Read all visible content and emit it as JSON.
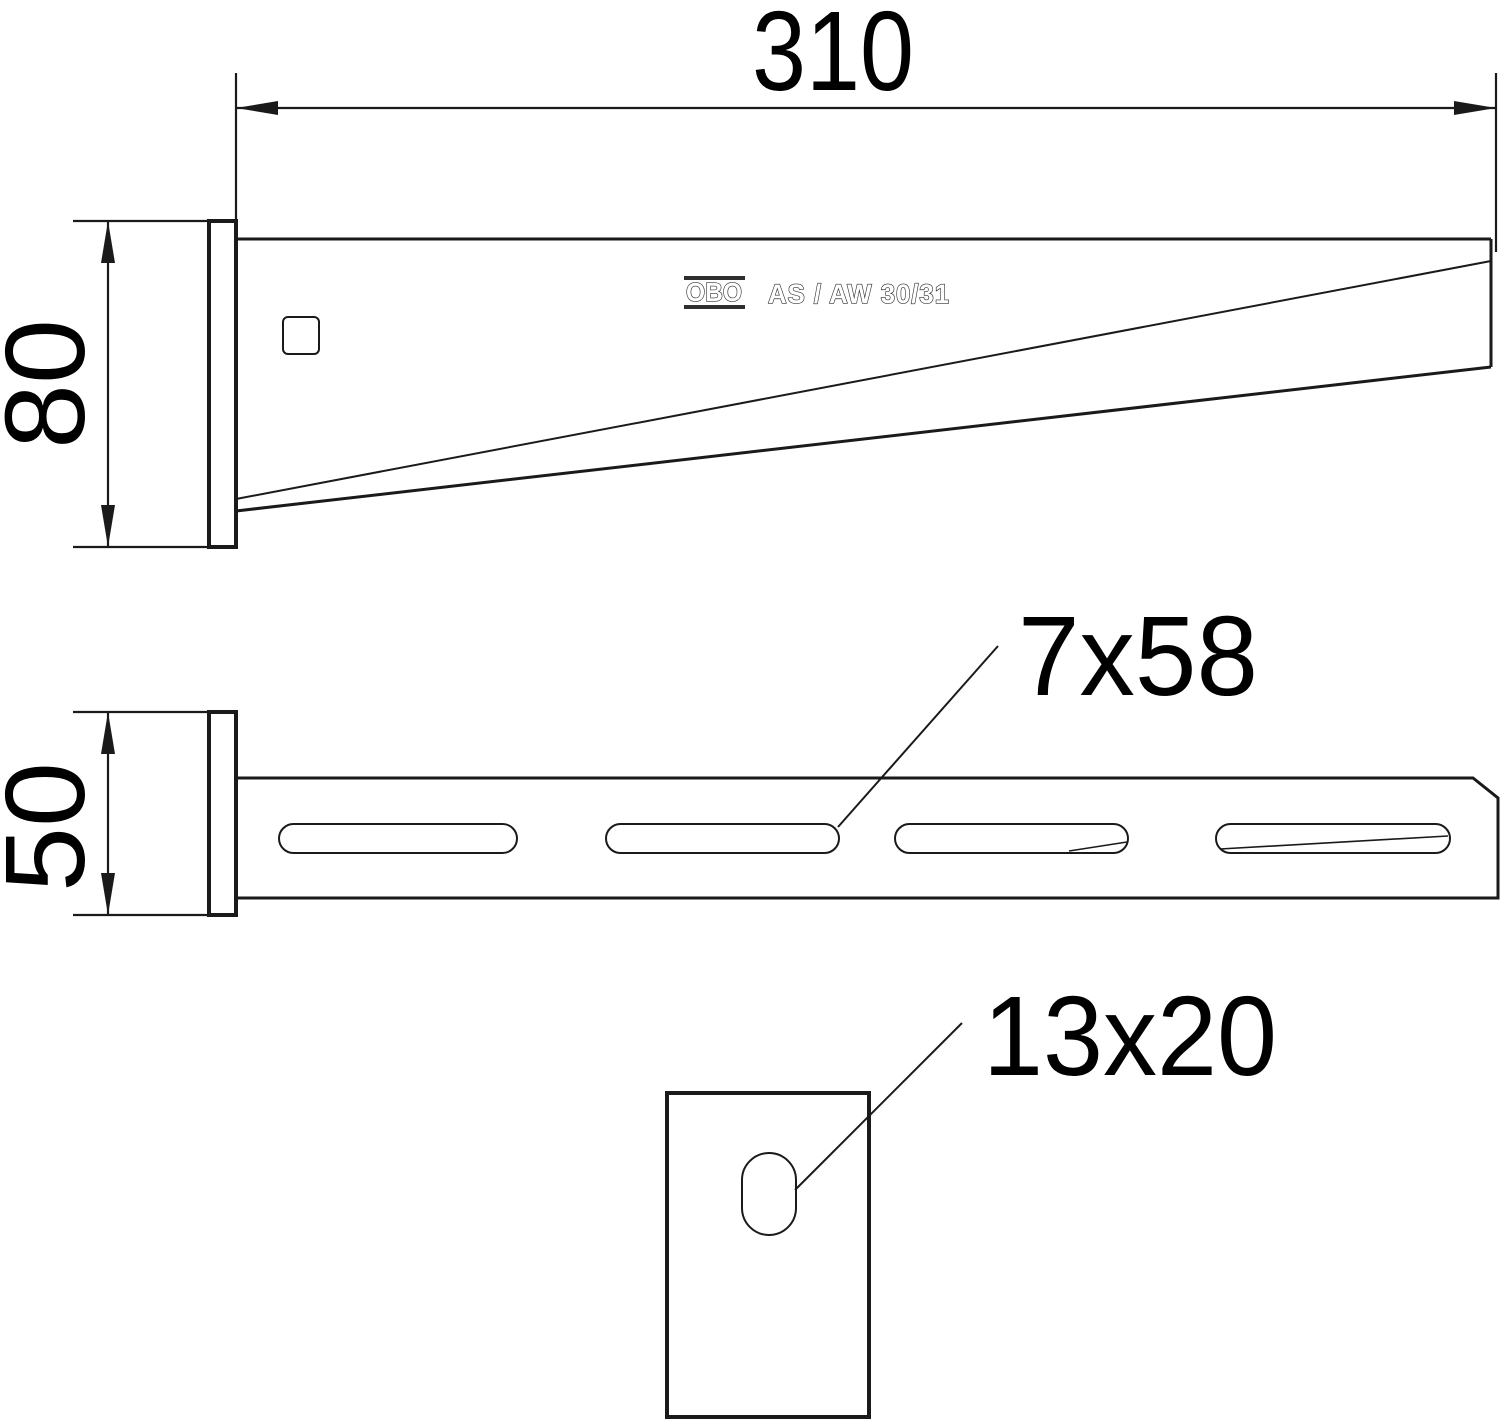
{
  "drawing": {
    "logo": "OBO",
    "product_code": "AS / AW 30/31",
    "dims": {
      "length": "310",
      "height": "80",
      "width": "50",
      "slot": "7x58",
      "hole": "13x20"
    }
  }
}
